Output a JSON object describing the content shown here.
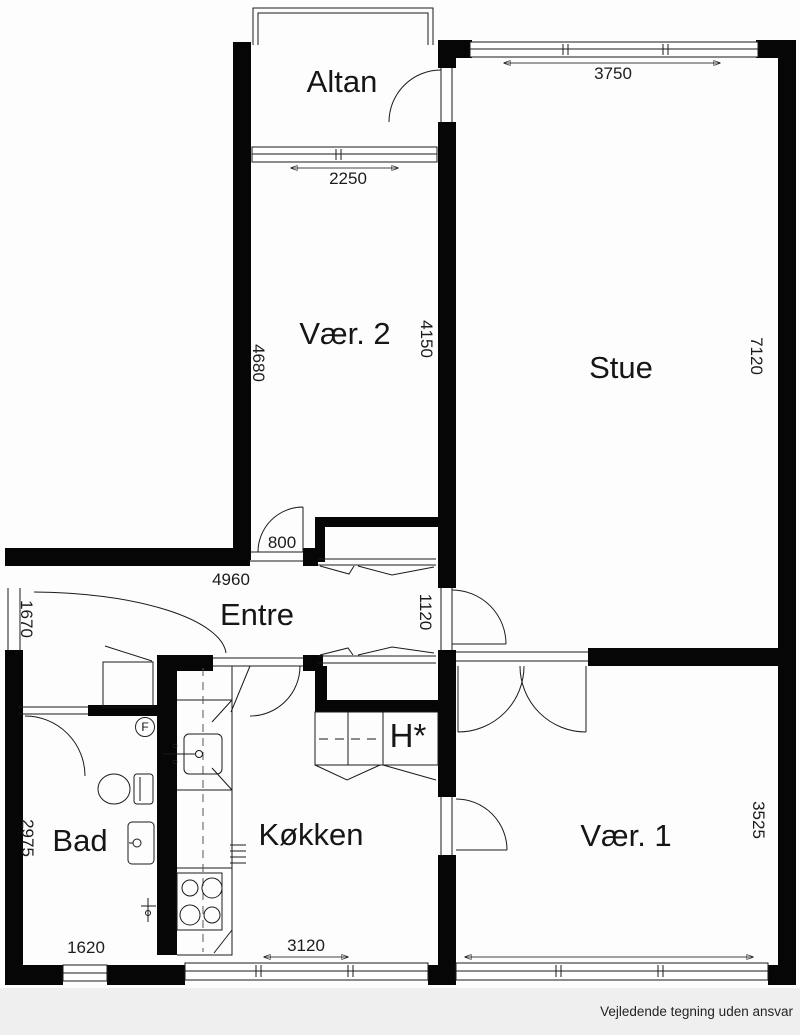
{
  "rooms": {
    "altan": "Altan",
    "vaer2": "Vær. 2",
    "stue": "Stue",
    "entre": "Entre",
    "bad": "Bad",
    "koekken": "Køkken",
    "vaer1": "Vær. 1",
    "closet": "H*"
  },
  "dimensions": {
    "altan_window": "2250",
    "stue_window": "3750",
    "vaer2_left": "4680",
    "vaer2_right": "4150",
    "stue_right": "7120",
    "entre_width": "4960",
    "vaer2_door": "800",
    "stue_door": "1120",
    "entry_door": "1670",
    "bad_left": "2975",
    "bad_window": "1620",
    "koekken_window": "3120",
    "vaer1_right": "3525"
  },
  "symbols": {
    "floor_drain": "F"
  },
  "footer": {
    "disclaimer": "Vejledende tegning uden ansvar"
  }
}
